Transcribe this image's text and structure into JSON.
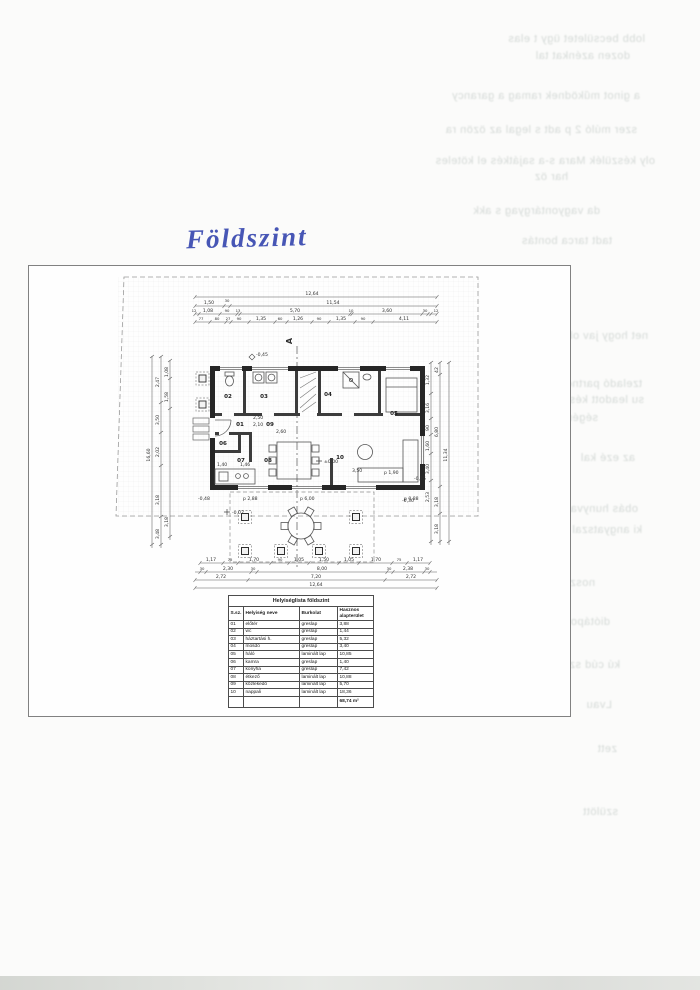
{
  "page": {
    "handwritten_title": "Földszint"
  },
  "plan": {
    "section_label": "A",
    "rooms": [
      "01",
      "02",
      "03",
      "04",
      "05",
      "06",
      "07",
      "08",
      "09",
      "10"
    ],
    "levels": {
      "entry": "-0,45",
      "zero": "±0,00",
      "terrace": "-0,02",
      "corner_sw": "-0,48",
      "corner_se": "-0,30",
      "right_edge": "-0,15"
    },
    "interior": {
      "d1": "2,50",
      "d2": "2,10",
      "d3": "2,60",
      "d4": "1,40",
      "d5": "1,46",
      "d6": "3,50",
      "d7": "p 1,90",
      "d8": "p 2,88",
      "d9": "p 6,00",
      "d10": "p 0,88"
    },
    "dims": {
      "top1": [
        "12,64"
      ],
      "top2": [
        "1,50",
        "30",
        "11,54"
      ],
      "top3": [
        "12",
        "1,08",
        "90",
        "13",
        "5,70",
        "10",
        "3,60",
        "30",
        "12"
      ],
      "top4": [
        "77",
        "80",
        "27",
        "90",
        "1,35",
        "60",
        "1,26",
        "90",
        "1,35",
        "90",
        "4,11"
      ],
      "bottom1": [
        "1,17",
        "75",
        "1,70",
        "90",
        "1,05",
        "1,50",
        "1,05",
        "1,70",
        "75",
        "1,17"
      ],
      "bottom2": [
        "30",
        "2,30",
        "30",
        "8,00",
        "30",
        "2,38",
        "30"
      ],
      "bottom3": [
        "2,72",
        "7,20",
        "2,72"
      ],
      "bottom4": [
        "12,64"
      ],
      "left": [
        "2,47",
        "3,50",
        "2,02",
        "3,18",
        "3,48",
        "1,08",
        "1,58",
        "3,18",
        "16,60"
      ],
      "right": [
        "1,32",
        "3,16",
        "90",
        "1,60",
        "3,40",
        "2,53",
        "42",
        "6,80",
        "3,18",
        "3,18",
        "11,34"
      ]
    }
  },
  "table": {
    "title": "Helyiséglista földszint",
    "headers": [
      "S.sz.",
      "Helyiség neve",
      "Burkolat",
      "Hasznos alapterület"
    ],
    "rows": [
      [
        "01",
        "előtér",
        "greslap",
        "3,88"
      ],
      [
        "02",
        "wc",
        "greslap",
        "1,44"
      ],
      [
        "03",
        "háztartási h.",
        "greslap",
        "5,32"
      ],
      [
        "04",
        "mosdó",
        "greslap",
        "3,40"
      ],
      [
        "05",
        "háló",
        "laminált lap",
        "10,85"
      ],
      [
        "06",
        "kamra",
        "greslap",
        "1,40"
      ],
      [
        "07",
        "konyha",
        "greslap",
        "7,42"
      ],
      [
        "08",
        "étkező",
        "laminált lap",
        "10,88"
      ],
      [
        "09",
        "közlekedő",
        "laminált lap",
        "5,70"
      ],
      [
        "10",
        "nappali",
        "laminált lap",
        "18,36"
      ]
    ],
    "total": "68,74 m²"
  },
  "bleedthrough": [
    "lobb becsületet ügy t elas",
    "dozen azénkat tal",
    "a ginot működnek ramag a garancy",
    "szer múló 2 p adt s legal az özön ra",
    "oly készülék Mara s-a sajátkés el köteles",
    "har öz",
    "da vagyontárgyag s akk",
    "tadt tarca bontás",
    "net hogy jav obbnome",
    "tzeladó partnerünk",
    "su leadott készüléke",
    "ségére.",
    "az ezé kal",
    "obás hunyva ságga",
    "ki angyatszal lépcsőkben a",
    "uszéri ne",
    "noszt",
    "diótápot",
    "kú cúd szerel",
    "Lvau",
    "zett",
    "szülött"
  ]
}
